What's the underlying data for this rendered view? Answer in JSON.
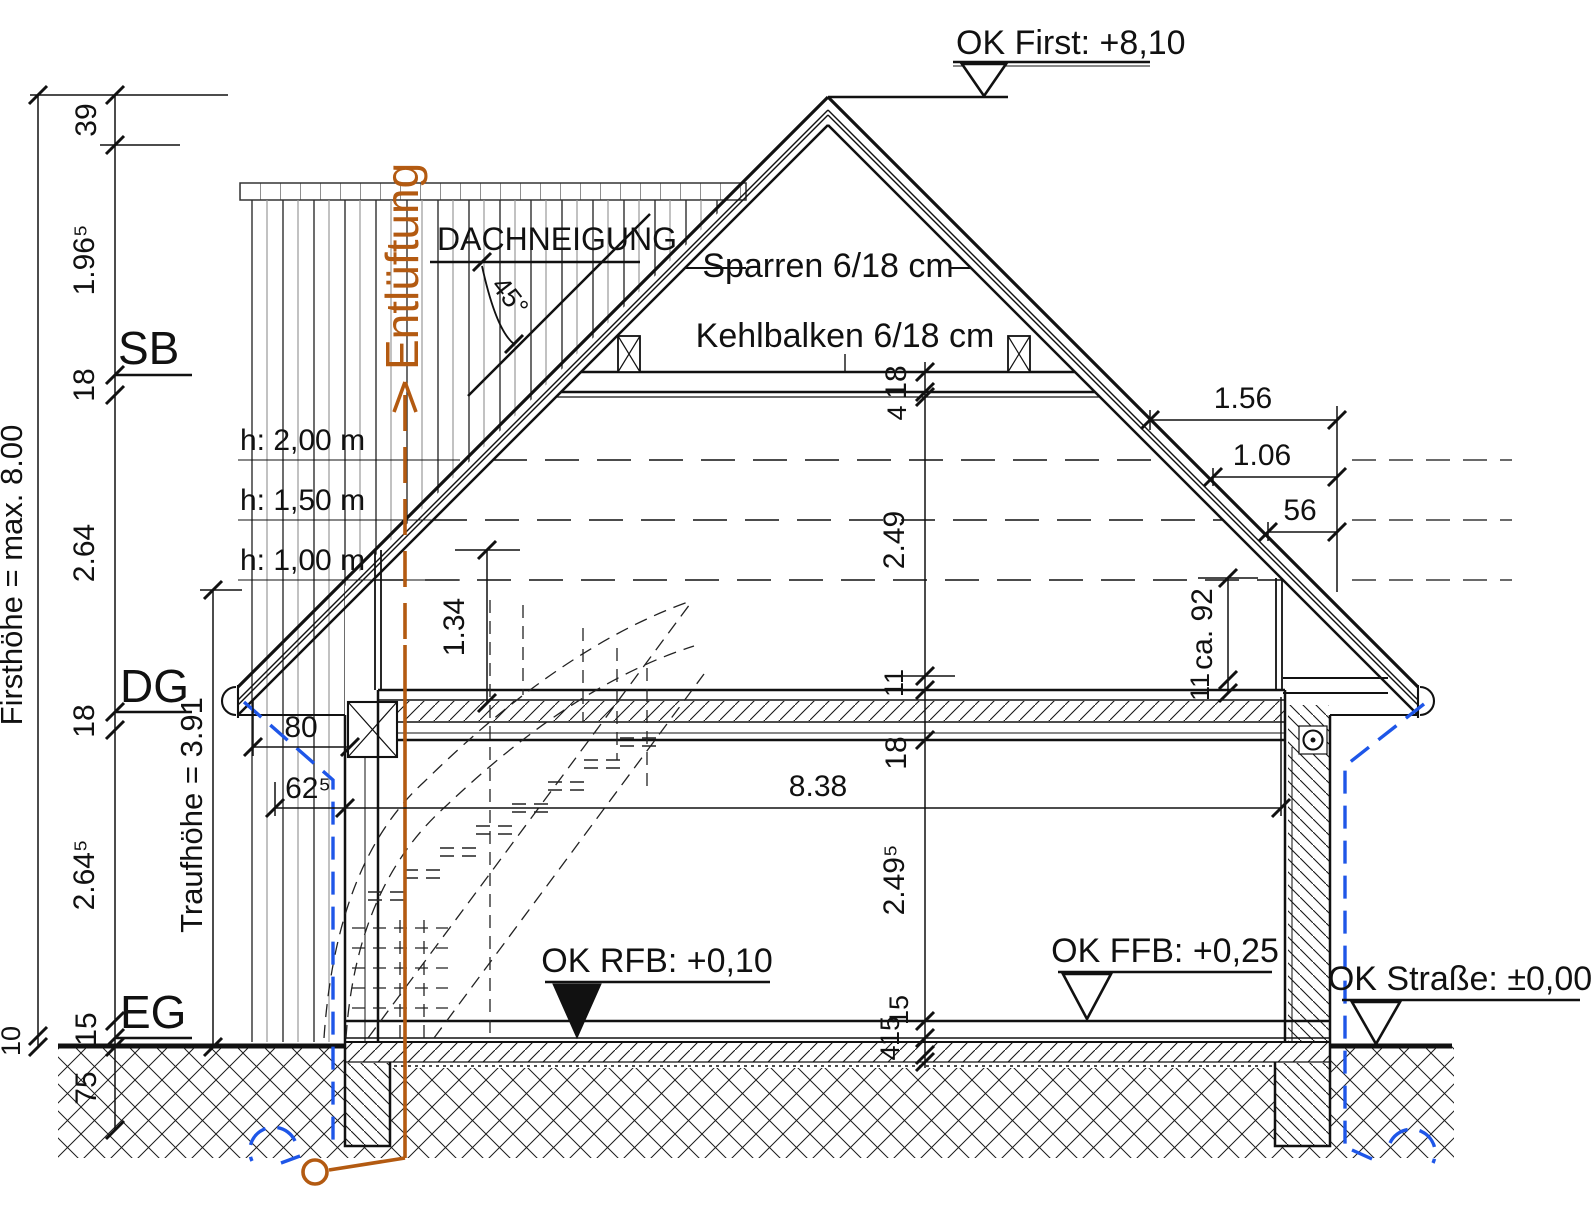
{
  "colors": {
    "accent_orange": "#b35a11",
    "accent_blue": "#1e56e8"
  },
  "levels": {
    "ok_first": "OK First: +8,10",
    "ok_rfb": "OK RFB: +0,10",
    "ok_ffb": "OK FFB: +0,25",
    "ok_strasse": "OK Straße: ±0,00"
  },
  "roof": {
    "dachneigung": "DACHNEIGUNG",
    "angle": "45°",
    "sparren": "Sparren 6/18 cm",
    "kehlbalken": "Kehlbalken 6/18 cm"
  },
  "vent_label": "Entlüftung",
  "headroom": {
    "h200": "h: 2,00 m",
    "h150": "h: 1,50 m",
    "h100": "h: 1,00 m"
  },
  "floors": {
    "sb": "SB",
    "dg": "DG",
    "eg": "EG"
  },
  "outer_dims": {
    "firsthoehe": "Firsthöhe = max. 8.00",
    "traufhoehe": "Traufhöhe = 3.91"
  },
  "left_chain": {
    "v39": "39",
    "v196": "1.96⁵",
    "v18a": "18",
    "v264": "2.64",
    "v18b": "18",
    "v2645": "2.64⁵",
    "v15": "15",
    "v10": "10",
    "v75": "75"
  },
  "center_chain": {
    "c18a": "18",
    "c4a": "4",
    "c249": "2.49",
    "c11": "11",
    "c18b": "18",
    "c2495": "2.49⁵",
    "c15a": "15",
    "c15b": "15",
    "c4b": "4"
  },
  "width_dims": {
    "w80": "80",
    "w625": "62⁵",
    "w838": "8.38"
  },
  "attic_dims": {
    "a134": "1.34",
    "a156": "1.56",
    "a106": "1.06",
    "a56": "56",
    "a92": "ca. 92",
    "a11": "11"
  }
}
